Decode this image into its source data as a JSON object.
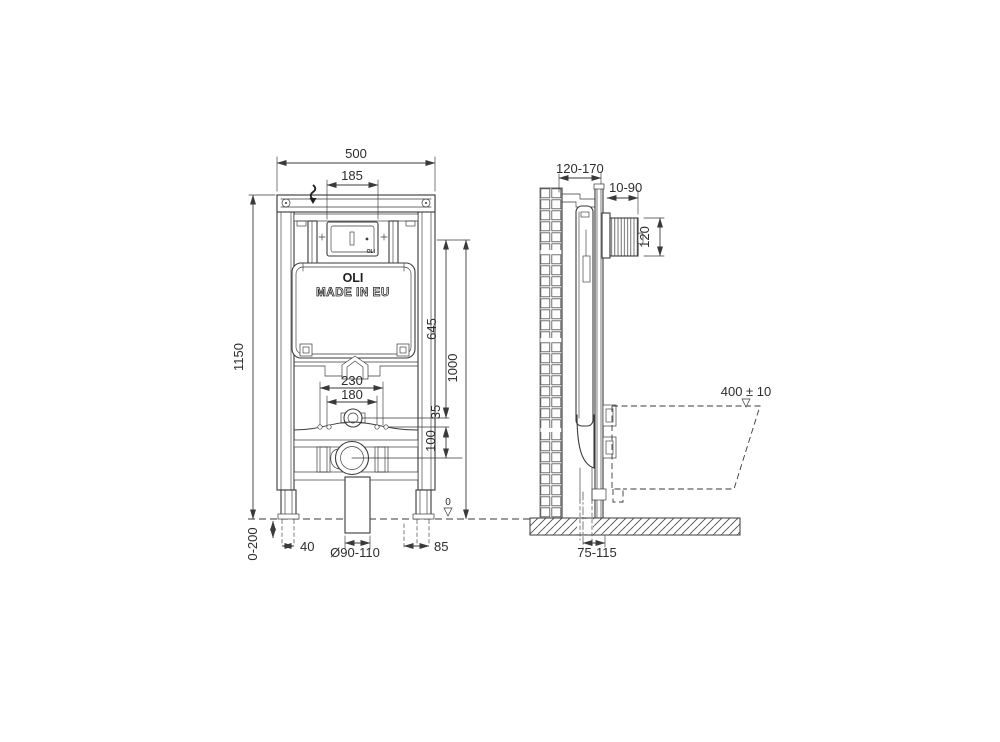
{
  "labels": {
    "brand": "OLI",
    "made_in": "MADE IN EU",
    "box_brand": "OLI"
  },
  "front": {
    "total_width": "500",
    "plate_width": "185",
    "total_height": "1150",
    "top_to_inlet": "645",
    "top_to_datum": "1000",
    "inlet_to_plate": "35",
    "plate_to_outlet": "100",
    "fixing_outer": "230",
    "fixing_inner": "180",
    "leg_adjust": "0-200",
    "foot_width": "40",
    "drain_dia": "Ø90-110",
    "foot_offset": "85",
    "datum": "0"
  },
  "side": {
    "frame_depth": "120-170",
    "plate_depth": "10-90",
    "box_height": "120",
    "bowl_height": "400 ± 10",
    "outlet_offset": "75-115"
  }
}
